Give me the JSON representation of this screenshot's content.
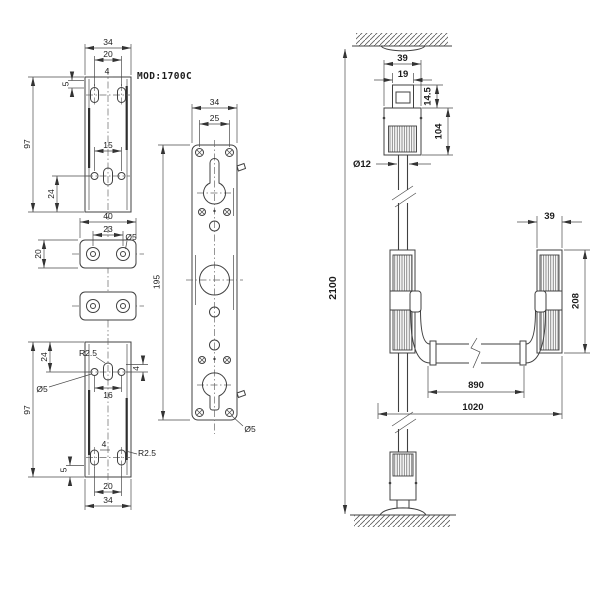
{
  "model_label": "MOD:1700C",
  "top_plate": {
    "width": "34",
    "slot_span": "20",
    "slot_width": "4",
    "edge_offset": "5",
    "height": "97",
    "hole_span": "15",
    "hole_offset": "24"
  },
  "cap_plate": {
    "width": "40",
    "hole_span": "23",
    "hole_diameter": "Ø5",
    "height": "20"
  },
  "bottom_plate": {
    "hole_offset": "24",
    "top_radius": "R2.5",
    "hole_diameter": "Ø5",
    "hole_span": "16",
    "side_offset": "4",
    "height": "97",
    "slot_width": "4",
    "bottom_radius": "R2.5",
    "edge_offset": "5",
    "slot_span": "20",
    "width": "34"
  },
  "main_plate": {
    "width": "34",
    "screw_span": "25",
    "height": "195",
    "hole_diameter": "Ø5"
  },
  "assembly": {
    "total_height": "2100",
    "head_width": "39",
    "latch_width": "19",
    "latch_offset": "14.5",
    "head_height": "104",
    "rod_diameter": "Ø12",
    "case_width": "39",
    "case_height": "208",
    "bar_length": "890",
    "overall_width": "1020"
  }
}
